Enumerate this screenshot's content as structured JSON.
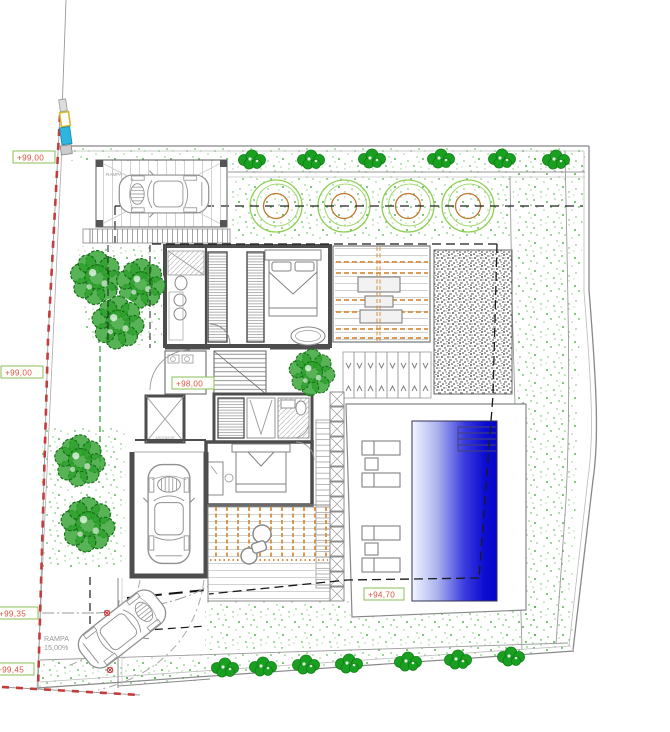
{
  "drawing": {
    "type": "architectural-site-plan",
    "labels": {
      "level_top": "+99,00",
      "level_left": "+99,00",
      "level_entry": "+98,00",
      "level_pool": "+94,70",
      "level_ramp_top": "+99,35",
      "level_ramp_bottom": "+99,45",
      "garage_ramp": "RAMPA",
      "driveway_ramp": "RAMPA",
      "driveway_slope": "15,00%",
      "elevator": "ASCENSOR"
    },
    "colors": {
      "label_text": "#d9534f",
      "label_box": "#8abf5a",
      "boundary_red": "#c43c3c",
      "garden_speckle": "#3aa834",
      "tree_green": "#2da02c",
      "planter_green": "#8ed055",
      "planter_orange": "#c07830",
      "deck_orange": "#d98e3c",
      "pool_blue": "#0505cc",
      "wall_gray": "#4d4d4d",
      "marker_cyan": "#2fb6e0",
      "marker_yellow": "#d4b92e"
    }
  }
}
